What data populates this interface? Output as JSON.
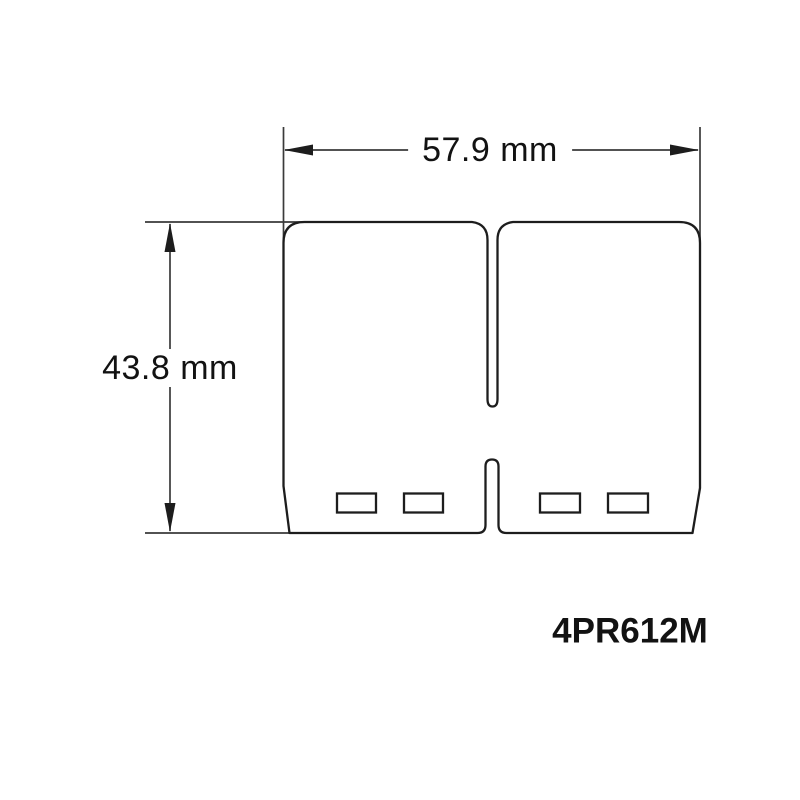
{
  "theme": {
    "background": "#ffffff",
    "line_color": "#1d1d1d",
    "dimension_line_color": "#3a3a3a",
    "text_color": "#121212"
  },
  "diagram": {
    "width_dimension": {
      "label": "57.9 mm",
      "value": 57.9,
      "unit": "mm"
    },
    "height_dimension": {
      "label": "43.8 mm",
      "value": 43.8,
      "unit": "mm"
    },
    "part_number": "4PR612M",
    "vent_slot_count": 4
  }
}
